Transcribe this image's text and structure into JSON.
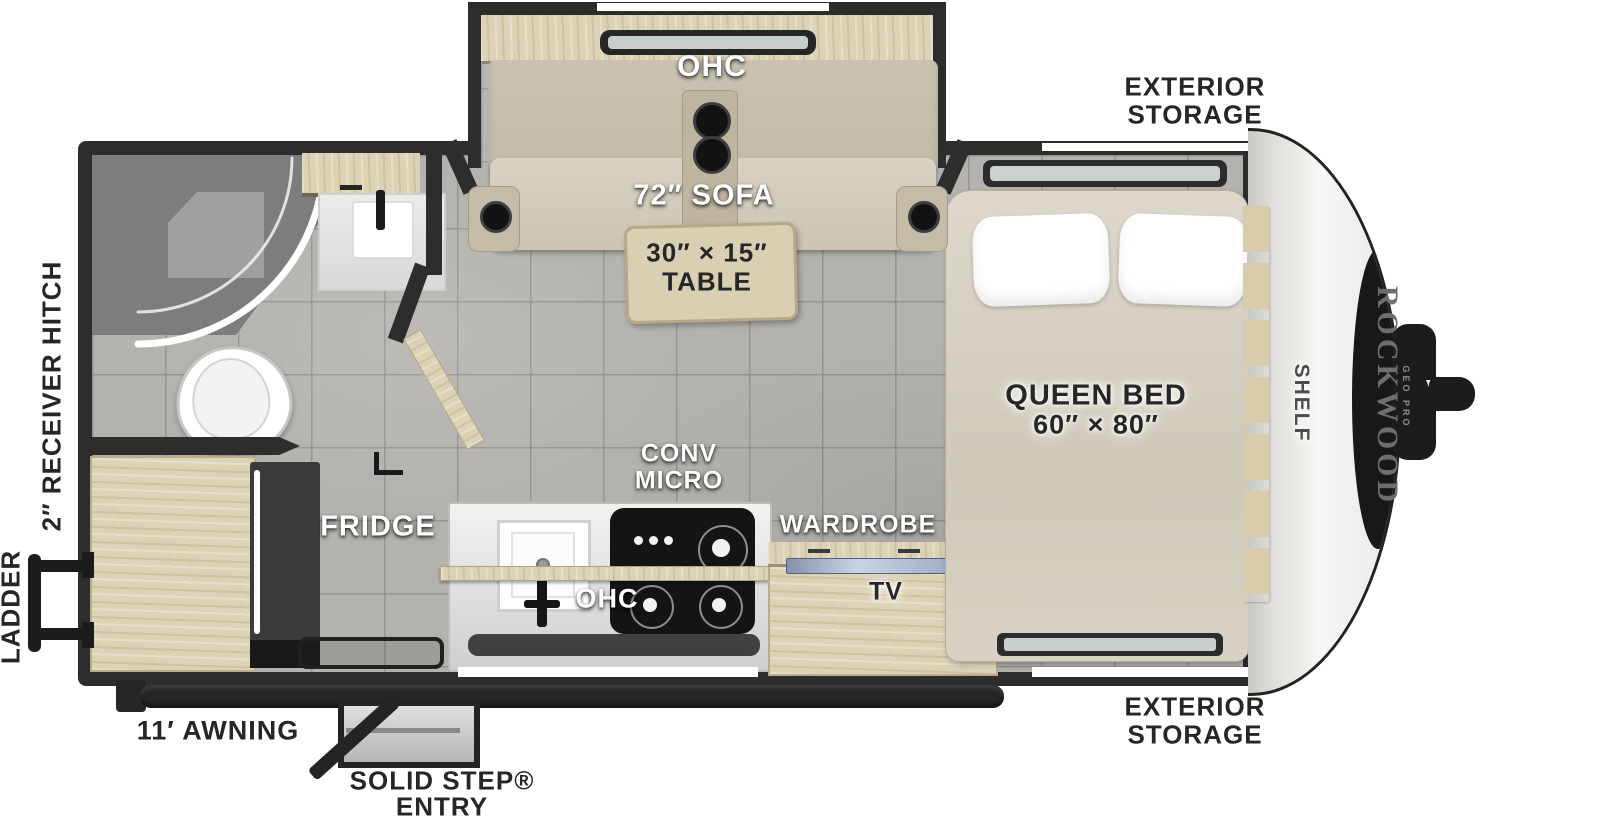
{
  "title": "Rockwood Geo Pro travel trailer floor plan",
  "colors": {
    "wall": "#2d2d2d",
    "floor_tile": "#b3b2ae",
    "wood_cabinet": "#dcd2b6",
    "label_white": "#ffffff",
    "label_dark": "#262626",
    "front_cap": "#f3f3f1",
    "cooktop": "#141414",
    "tv_screen": "#9aa8c4"
  },
  "slide_out": {
    "ohc": "OHC",
    "sofa": "72″ SOFA",
    "table_line1": "30″ × 15″",
    "table_line2": "TABLE"
  },
  "bedroom": {
    "storage_top_line1": "EXTERIOR",
    "storage_top_line2": "STORAGE",
    "bed_line1": "QUEEN BED",
    "bed_line2": "60″ × 80″",
    "shelf": "SHELF",
    "storage_bottom_line1": "EXTERIOR",
    "storage_bottom_line2": "STORAGE"
  },
  "front_cap": {
    "brand": "ROCKWOOD",
    "model": "GEO PRO"
  },
  "rear": {
    "hitch": "2″ RECEIVER HITCH",
    "ladder": "LADDER"
  },
  "kitchen": {
    "fridge": "FRIDGE",
    "conv_line1": "CONV",
    "conv_line2": "MICRO",
    "ohc": "OHC",
    "wardrobe": "WARDROBE",
    "tv": "TV"
  },
  "exterior_bottom": {
    "awning": "11′ AWNING",
    "step_line1": "SOLID STEP®",
    "step_line2": "ENTRY"
  }
}
